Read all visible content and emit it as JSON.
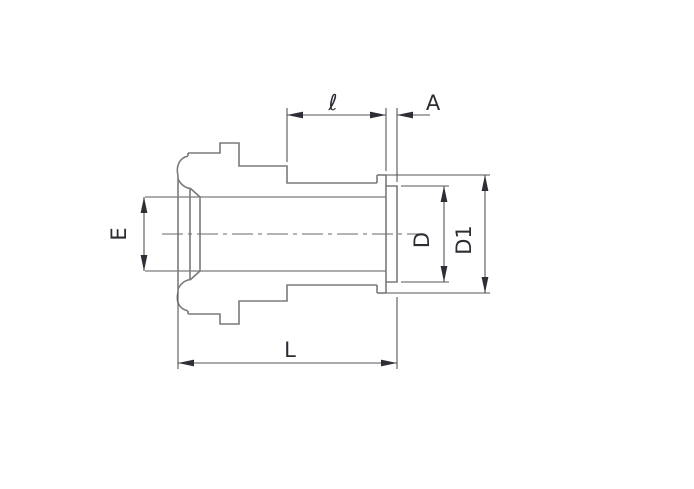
{
  "drawing": {
    "type": "technical-dimension-diagram",
    "description": "Side-view engineering drawing of a tube weld gland fitting with dimension callouts",
    "labels": {
      "neck_length": "ℓ",
      "end_thickness": "A",
      "bore_diameter": "E",
      "socket_diameter": "D",
      "flange_diameter": "D1",
      "overall_length": "L"
    },
    "colors": {
      "background": "#ffffff",
      "outline": "#7a7a7a",
      "dimension_line": "#55555a",
      "arrow": "#2e2e36",
      "label_text": "#2c2c34"
    }
  }
}
